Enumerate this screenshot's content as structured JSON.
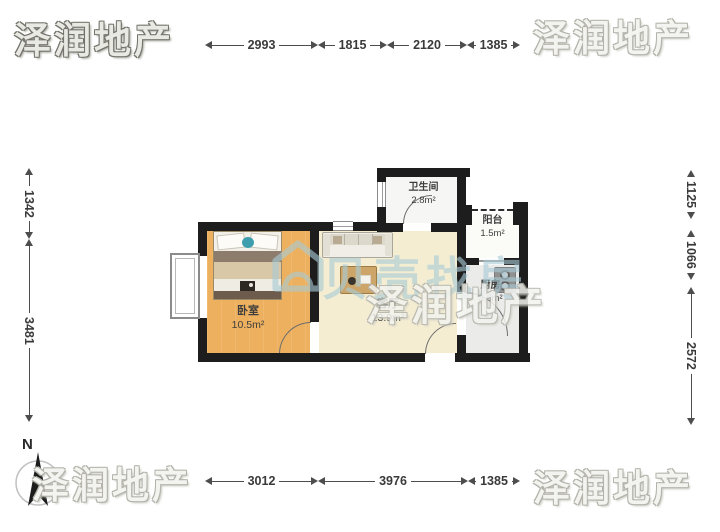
{
  "brand_watermark": {
    "text": "泽润地产"
  },
  "center_watermark": {
    "text": "贝壳找房",
    "logo_icon": "beike-house-logo"
  },
  "compass": {
    "north_label": "N"
  },
  "dimensions_mm": {
    "top": [
      "2993",
      "1815",
      "2120",
      "1385"
    ],
    "bottom": [
      "3012",
      "3976",
      "1385"
    ],
    "left": [
      "1342",
      "3481"
    ],
    "right": [
      "1125",
      "1066",
      "2572"
    ]
  },
  "rooms": [
    {
      "name": "卧室",
      "area": "10.5m²"
    },
    {
      "name": "客厅",
      "area": "13.9m²"
    },
    {
      "name": "卫生间",
      "area": "2.8m²"
    },
    {
      "name": "阳台",
      "area": "1.5m²"
    },
    {
      "name": "厨房",
      "area": "3.6m²"
    }
  ],
  "icons": {
    "furniture": [
      "bed-icon",
      "sofa-icon",
      "coffee-table-icon",
      "stove-icon"
    ],
    "compass": "north-arrow-icon"
  },
  "colors": {
    "wall": "#1d1d1d",
    "bedroom_floor": "#edb05e",
    "living_floor": "#f4edd2",
    "kitchen_floor": "#ebebe9",
    "bathroom_floor": "#f6f6f4",
    "balcony_floor": "#fbfbf8",
    "watermark_gray": "#b3b3ab",
    "watermark_teal": "#a8cbd5",
    "dimension_text": "#3a3a3a"
  }
}
